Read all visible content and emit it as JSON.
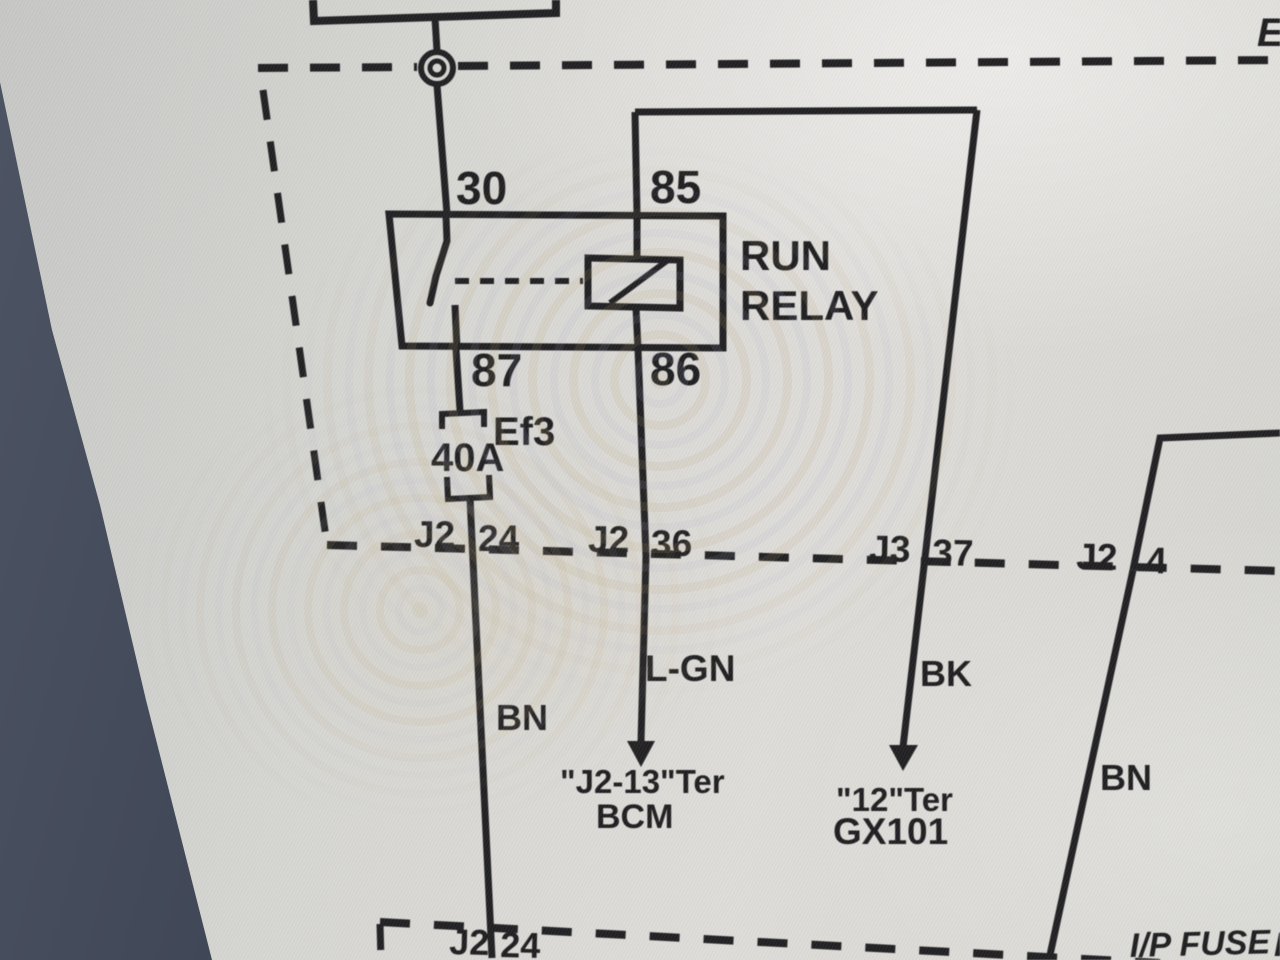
{
  "colors": {
    "line": "#1e1e20",
    "screen_background": "#d6d6d2",
    "bezel": "#3a4150"
  },
  "diagram": {
    "top_right_partial": "E",
    "relay": {
      "name_line1": "RUN",
      "name_line2": "RELAY",
      "terminal_30": "30",
      "terminal_85": "85",
      "terminal_87": "87",
      "terminal_86": "86"
    },
    "fuse": {
      "id": "Ef3",
      "rating": "40A"
    },
    "connector_row": [
      {
        "conn": "J2",
        "pin": "24"
      },
      {
        "conn": "J2",
        "pin": "36"
      },
      {
        "conn": "J3",
        "pin": "37"
      },
      {
        "conn": "J2",
        "pin": "4"
      }
    ],
    "wires": {
      "left": "BN",
      "center": "L-GN",
      "right": "BK",
      "far_right": "BN"
    },
    "terminations": {
      "bcm_line1": "\"J2-13\"Ter",
      "bcm_line2": "BCM",
      "gx101_line1": "\"12\"Ter",
      "gx101_line2": "GX101"
    },
    "bottom_connector": {
      "conn": "J2",
      "pin": "24"
    },
    "bottom_right_label": "I/P FUSE",
    "bottom_right_partial": "B"
  }
}
